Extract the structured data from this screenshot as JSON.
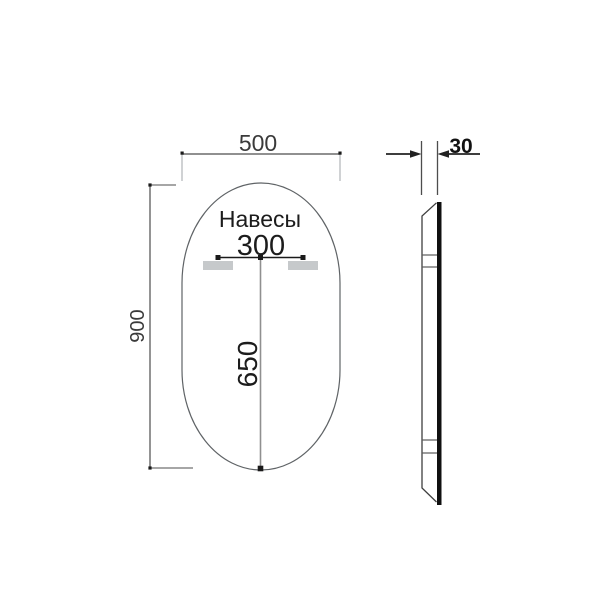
{
  "drawing": {
    "front_view": {
      "width_dim": "500",
      "height_dim": "900",
      "hangers_label": "Навесы",
      "hanger_spacing_dim": "300",
      "hanger_to_bottom_dim": "650"
    },
    "side_view": {
      "depth_dim": "30"
    },
    "colors": {
      "dimension_line": "#4d4d4d",
      "extension_line": "#a9aeb1",
      "outline": "#5f6366",
      "marker": "#1a1a1a",
      "hanger_fill": "#c6c9cb",
      "hanger_line": "#1a1a1a",
      "center_line": "#909090",
      "glass_edge": "#101010",
      "profile_line": "#3f3f3f",
      "bracket_line": "#5a5a5a",
      "depth_dim_line": "#222222"
    }
  }
}
